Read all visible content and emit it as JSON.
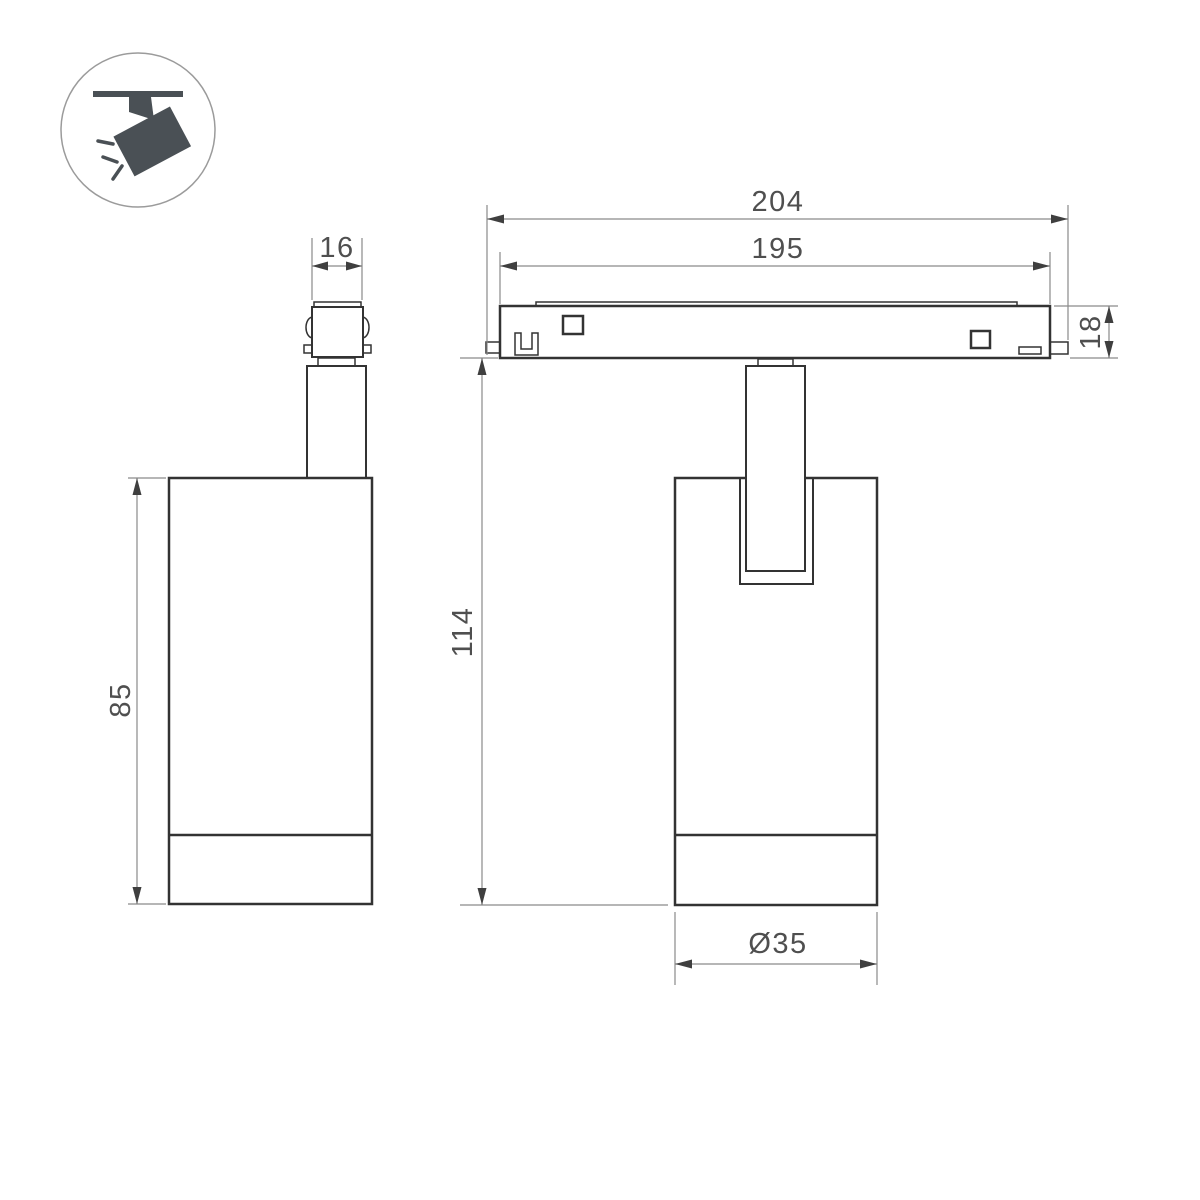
{
  "drawing": {
    "type": "technical-dimension-drawing",
    "subject": "magnetic-track-spot-luminaire",
    "views": {
      "side_view": "side-view-with-track-adapter",
      "front_view": "front-view-on-track-rail"
    }
  },
  "icon": {
    "name": "ceiling-track-spotlight-icon",
    "color": "#4a5055",
    "circle_color": "#9b9b9b"
  },
  "dimensions": {
    "adapter_width": "16",
    "rail_overall_width": "204",
    "rail_body_width": "195",
    "rail_height": "18",
    "overall_height": "114",
    "body_height": "85",
    "body_diameter": "Ø35"
  },
  "colors": {
    "outline": "#333333",
    "dim": "#8a8a8a",
    "arrow": "#3f3f3f",
    "dimtext": "#4f4f4f",
    "icon": "#4a5055",
    "iconcircle": "#9b9b9b",
    "bg": "#ffffff"
  }
}
